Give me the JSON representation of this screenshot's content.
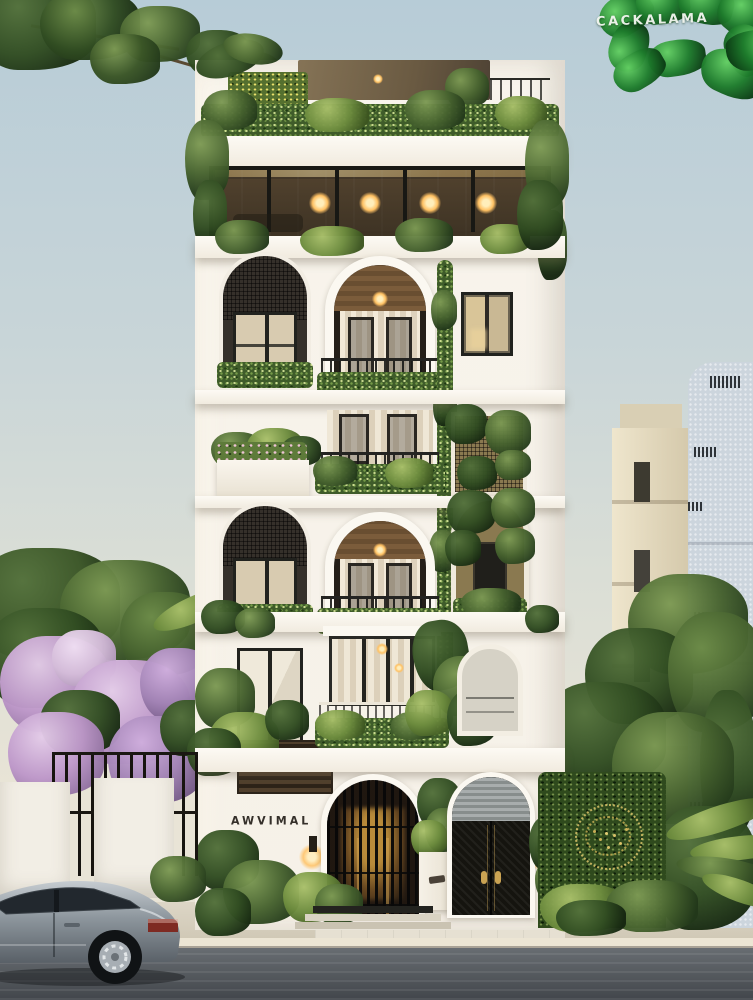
{
  "watermark": {
    "text": "CACKALAMA",
    "style": "white hand-drawn lettering over glossy green leaf ring, top-right corner"
  },
  "building": {
    "sign_text": "AWVIMAL",
    "hedge_monogram": "illegible gold dot lettering on green hedge",
    "facade": "narrow white 6-storey residence with arched balconies and cascading planting",
    "floors": [
      {
        "level": "rooftop",
        "features": "dark pergola canopy, planted parapet, yellow flowering green wall, warm downlight"
      },
      {
        "level": "penthouse",
        "features": "full-width glazing, timber interior, four warm ceiling downlights"
      },
      {
        "level": "4",
        "features": "arched screened window, large arched balcony with timber ceiling, downlight and curtains, rectangular window, climbing vine column"
      },
      {
        "level": "3",
        "features": "flower planter box, curtained balcony with planted railing, vine-covered golden mesh screen"
      },
      {
        "level": "2",
        "features": "arched screened window, arched balcony with downlight, arched golden-mesh balcony overgrown with vines"
      },
      {
        "level": "1",
        "features": "rectangular window, curtained glass balcony with planted railing, pointed-arch window, dark louvre panel, large tropical plant"
      },
      {
        "level": "ground",
        "features": "name sign, two warm wall sconces, arched entry gate with vertical bars and lit lobby, arched black double-door gate, white planter with shrub, three entry steps"
      }
    ]
  },
  "surroundings": {
    "left": "white boundary wall with black metal fence, purple flowering tree, overhanging branches top-left",
    "right": "green hedge wall with gold monogram, trees, beige apartment block and pale blue textured tower, palm fronds",
    "street": "beige sidewalk with stone curb, dark asphalt road with horizontal streaks",
    "vehicle": "silver sedan parked at left, rear three-quarter visible"
  },
  "colors": {
    "sky_top": "#b7ccd7",
    "sky_low": "#e9e4d6",
    "facade": "#f6f1e8",
    "trim": "#fbf8f1",
    "glass": "#2b2822",
    "wood": "#7b5c3b",
    "warm_light": "#ffc469",
    "leaf_dark": "#22381a",
    "leaf_mid": "#47632f",
    "leaf_light": "#7d9a54",
    "blossom": "#bd97c9",
    "gate_black": "#141311",
    "gold": "#d8bf6a",
    "hedge": "#2f4a1d",
    "road": "#42464b",
    "sidewalk": "#d7d0c0",
    "car_silver": "#8d969d",
    "neighbor_beige": "#e3d9bf",
    "neighbor_gray": "#ccd5dd"
  }
}
